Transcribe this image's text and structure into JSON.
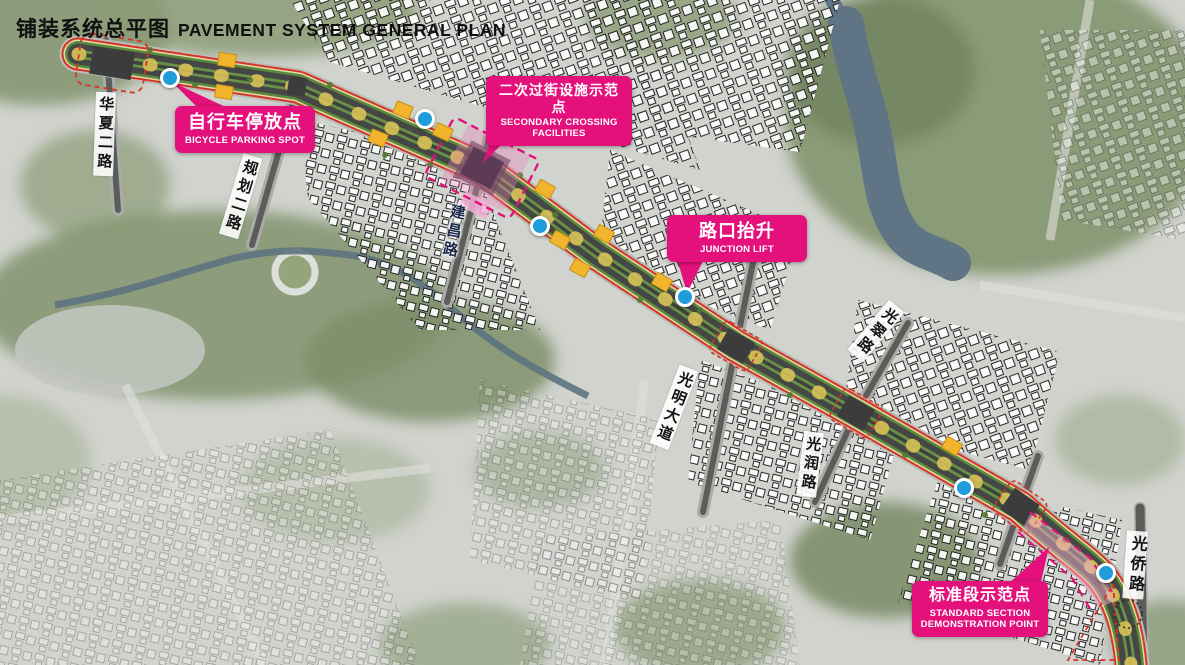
{
  "title": {
    "zh": "铺装系统总平图",
    "en": "PAVEMENT SYSTEM GENERAL PLAN"
  },
  "callouts": [
    {
      "id": "bicycle-parking",
      "zh": "自行车停放点",
      "en": "BICYCLE PARKING SPOT"
    },
    {
      "id": "secondary-crossing",
      "zh": "二次过街设施示范点",
      "en": "SECONDARY CROSSING FACILITIES"
    },
    {
      "id": "junction-lift",
      "zh": "路口抬升",
      "en": "JUNCTION LIFT"
    },
    {
      "id": "standard-section",
      "zh": "标准段示范点",
      "en": "STANDARD SECTION DEMONSTRATION POINT"
    }
  ],
  "roads": [
    {
      "name": "华夏二路"
    },
    {
      "name": "规划二路"
    },
    {
      "name": "建昌路"
    },
    {
      "name": "光明大道"
    },
    {
      "name": "光翠路"
    },
    {
      "name": "光润路"
    },
    {
      "name": "光侨路"
    }
  ],
  "colors": {
    "accent_pink": "#e4117c",
    "spot_blue": "#1f9ddb",
    "crossing_yellow": "#f2b42d",
    "outline_red": "#d63426"
  },
  "map": {
    "spots": [
      {
        "x": 170,
        "y": 78
      },
      {
        "x": 425,
        "y": 119
      },
      {
        "x": 540,
        "y": 226
      },
      {
        "x": 685,
        "y": 297
      },
      {
        "x": 964,
        "y": 488
      },
      {
        "x": 1106,
        "y": 573
      }
    ],
    "crossings": [
      {
        "x": 227,
        "y": 60,
        "a": 9
      },
      {
        "x": 224,
        "y": 92,
        "a": 9
      },
      {
        "x": 403,
        "y": 110,
        "a": 22
      },
      {
        "x": 378,
        "y": 138,
        "a": 22
      },
      {
        "x": 443,
        "y": 132,
        "a": 25
      },
      {
        "x": 545,
        "y": 189,
        "a": 29
      },
      {
        "x": 604,
        "y": 234,
        "a": 29
      },
      {
        "x": 560,
        "y": 240,
        "a": 29
      },
      {
        "x": 580,
        "y": 268,
        "a": 29
      },
      {
        "x": 662,
        "y": 282,
        "a": 30
      },
      {
        "x": 952,
        "y": 446,
        "a": 30
      }
    ]
  }
}
